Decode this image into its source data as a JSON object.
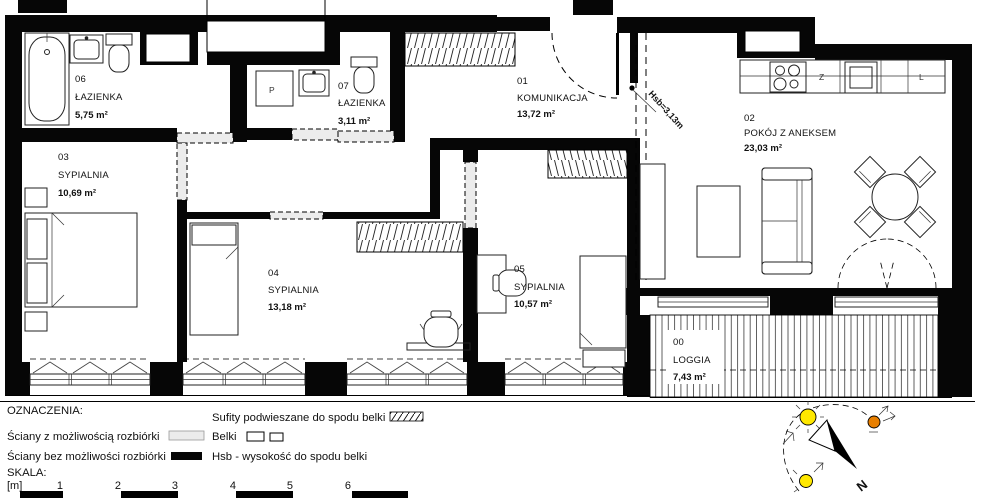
{
  "plan": {
    "rooms": [
      {
        "id": "06",
        "name": "ŁAZIENKA",
        "area": "5,75 m²"
      },
      {
        "id": "07",
        "name": "ŁAZIENKA",
        "area": "3,11 m²"
      },
      {
        "id": "01",
        "name": "KOMUNIKACJA",
        "area": "13,72 m²"
      },
      {
        "id": "02",
        "name": "POKÓJ Z ANEKSEM",
        "area": "23,03 m²"
      },
      {
        "id": "03",
        "name": "SYPIALNIA",
        "area": "10,69 m²"
      },
      {
        "id": "04",
        "name": "SYPIALNIA",
        "area": "13,18 m²"
      },
      {
        "id": "05",
        "name": "SYPIALNIA",
        "area": "10,57 m²"
      },
      {
        "id": "00",
        "name": "LOGGIA",
        "area": "7,43 m²"
      }
    ],
    "kitchen": {
      "sink_label": "Z",
      "fridge_label": "L",
      "washer_label": "P"
    },
    "annotations": {
      "hsb": "Hsb=3,13m",
      "north": "N"
    }
  },
  "legend": {
    "title": "OZNACZENIA:",
    "items": [
      {
        "label": "Ściany z możliwością rozbiórki"
      },
      {
        "label": "Ściany bez możliwości rozbiórki"
      },
      {
        "label": "Sufity podwieszane do spodu belki"
      },
      {
        "label": "Belki"
      },
      {
        "label": "Hsb - wysokość do spodu belki"
      }
    ],
    "scale": {
      "title": "SKALA:",
      "unit": "[m]",
      "ticks": [
        "1",
        "2",
        "3",
        "4",
        "5",
        "6"
      ]
    }
  },
  "colors": {
    "wall": "#060606",
    "demolishable": "#ececec",
    "sun_yellow": "#ffe800",
    "sun_orange": "#e87f00"
  }
}
